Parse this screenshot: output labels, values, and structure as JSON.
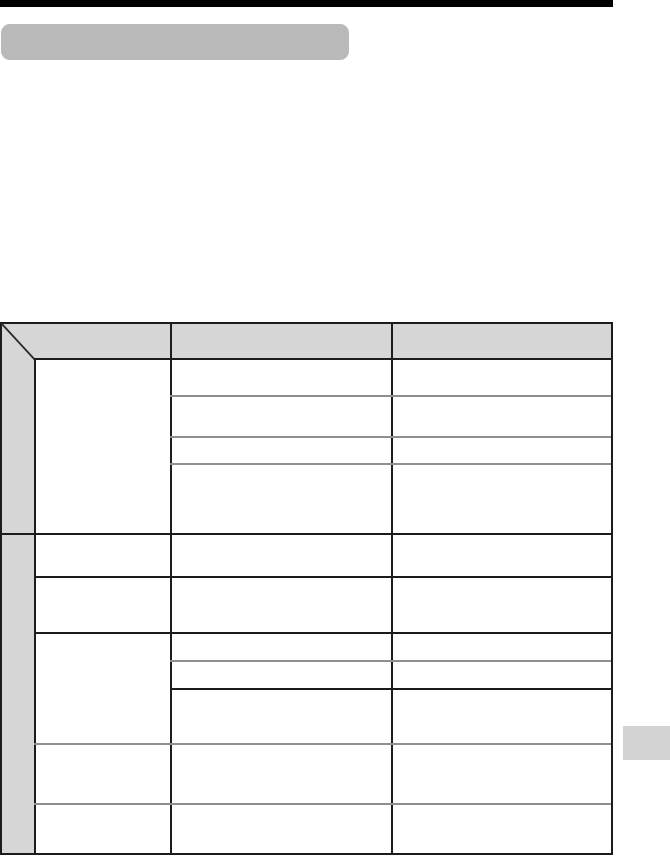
{
  "colors": {
    "page_bg": "#ffffff",
    "top_bar": "#000000",
    "heading_pill": "#b9b9b9",
    "table_fill_gray": "#d6d6d6",
    "line_black": "#1c1c1c",
    "line_gray": "#8f8f8f",
    "page_tab": "#d2d2d2",
    "diagonal": "#2a2a2a"
  },
  "table": {
    "columns": 3,
    "has_category_strip_column": true,
    "has_diagonal_corner_cell": true,
    "row_groups": 2,
    "all_cells_empty": true,
    "row_lines": [
      {
        "y": 36,
        "start": "strip",
        "tone": "black"
      },
      {
        "y": 73,
        "start": "col2",
        "tone": "gray"
      },
      {
        "y": 114,
        "start": "col2",
        "tone": "gray"
      },
      {
        "y": 141,
        "start": "col2",
        "tone": "gray"
      },
      {
        "y": 211,
        "start": "left",
        "tone": "black"
      },
      {
        "y": 254,
        "start": "strip",
        "tone": "black"
      },
      {
        "y": 310,
        "start": "strip",
        "tone": "black"
      },
      {
        "y": 338,
        "start": "col2",
        "tone": "gray"
      },
      {
        "y": 366,
        "start": "col2",
        "tone": "black"
      },
      {
        "y": 421,
        "start": "strip",
        "tone": "gray"
      },
      {
        "y": 481,
        "start": "strip",
        "tone": "gray"
      }
    ]
  }
}
